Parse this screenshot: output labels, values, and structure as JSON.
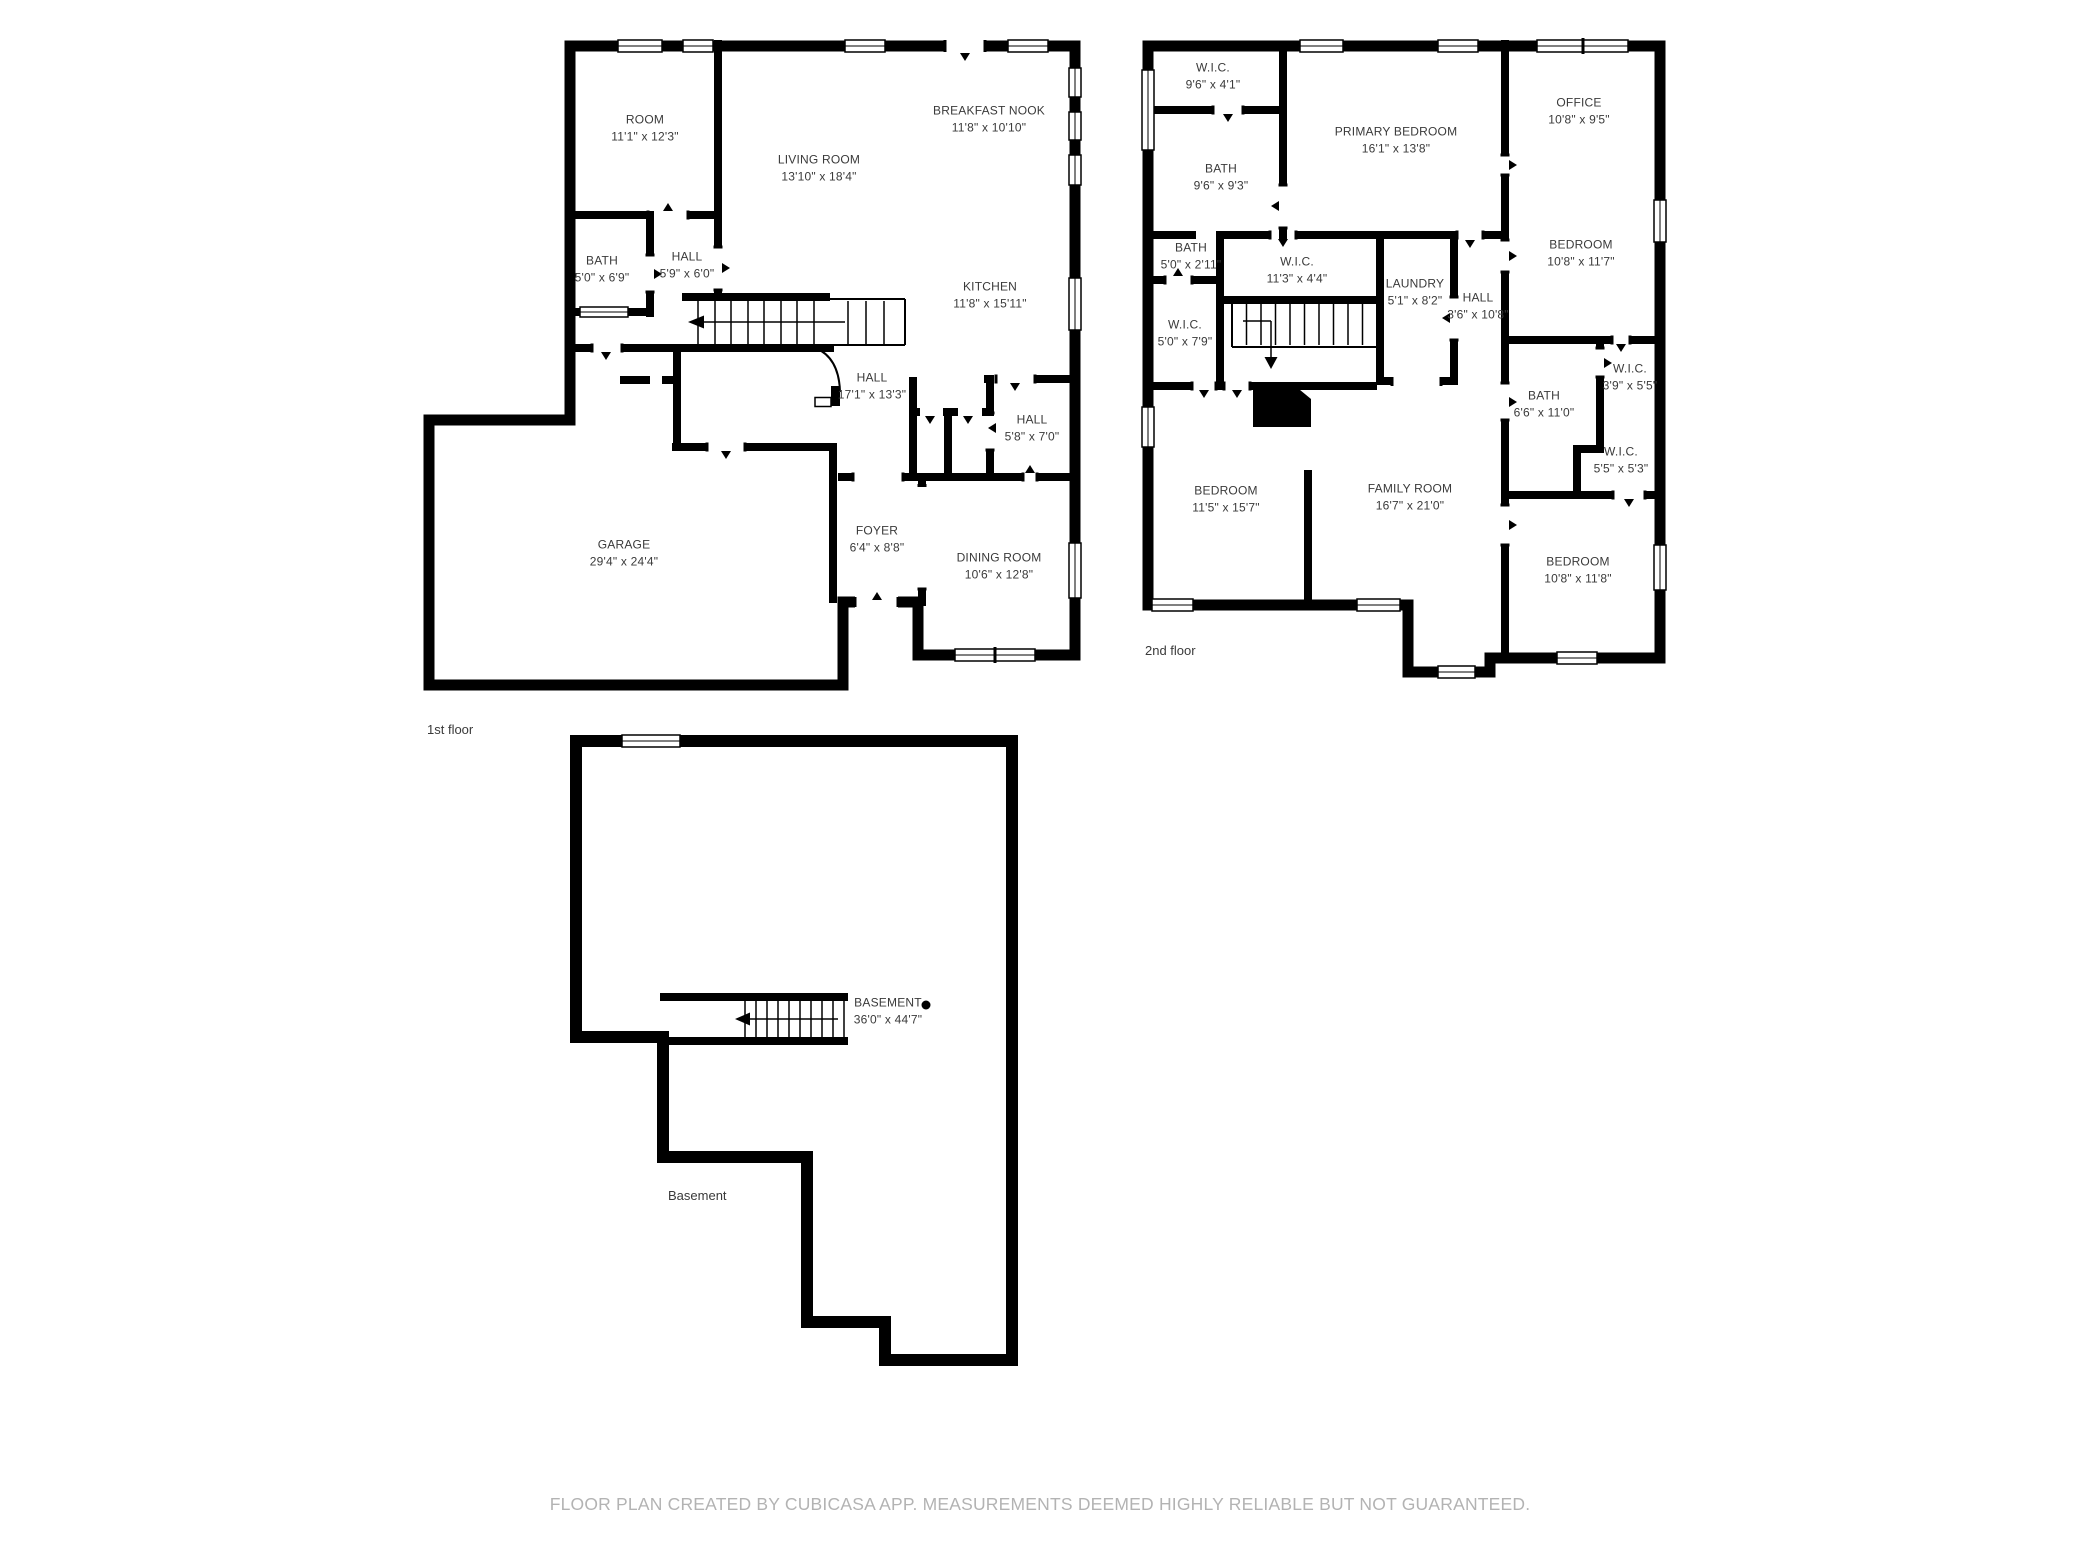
{
  "floors": [
    {
      "name": "1st floor",
      "name_pos": {
        "x": 427,
        "y": 722
      },
      "rooms": [
        {
          "label": "ROOM",
          "dims": "11'1\" x 12'3\"",
          "x": 645,
          "y": 128
        },
        {
          "label": "LIVING ROOM",
          "dims": "13'10\" x 18'4\"",
          "x": 819,
          "y": 168
        },
        {
          "label": "BREAKFAST NOOK",
          "dims": "11'8\" x 10'10\"",
          "x": 989,
          "y": 119
        },
        {
          "label": "KITCHEN",
          "dims": "11'8\" x 15'11\"",
          "x": 990,
          "y": 295
        },
        {
          "label": "BATH",
          "dims": "5'0\" x 6'9\"",
          "x": 602,
          "y": 269
        },
        {
          "label": "HALL",
          "dims": "5'9\" x 6'0\"",
          "x": 687,
          "y": 265
        },
        {
          "label": "HALL",
          "dims": "17'1\" x 13'3\"",
          "x": 872,
          "y": 386
        },
        {
          "label": "HALL",
          "dims": "5'8\" x 7'0\"",
          "x": 1032,
          "y": 428
        },
        {
          "label": "FOYER",
          "dims": "6'4\" x 8'8\"",
          "x": 877,
          "y": 539
        },
        {
          "label": "DINING ROOM",
          "dims": "10'6\" x 12'8\"",
          "x": 999,
          "y": 566
        },
        {
          "label": "GARAGE",
          "dims": "29'4\" x 24'4\"",
          "x": 624,
          "y": 553
        }
      ]
    },
    {
      "name": "2nd floor",
      "name_pos": {
        "x": 1145,
        "y": 643
      },
      "rooms": [
        {
          "label": "W.I.C.",
          "dims": "9'6\" x 4'1\"",
          "x": 1213,
          "y": 76
        },
        {
          "label": "PRIMARY BEDROOM",
          "dims": "16'1\" x 13'8\"",
          "x": 1396,
          "y": 140
        },
        {
          "label": "OFFICE",
          "dims": "10'8\" x 9'5\"",
          "x": 1579,
          "y": 111
        },
        {
          "label": "BATH",
          "dims": "9'6\" x 9'3\"",
          "x": 1221,
          "y": 177
        },
        {
          "label": "BEDROOM",
          "dims": "10'8\" x 11'7\"",
          "x": 1581,
          "y": 253
        },
        {
          "label": "BATH",
          "dims": "5'0\" x 2'11\"",
          "x": 1191,
          "y": 256
        },
        {
          "label": "W.I.C.",
          "dims": "11'3\" x 4'4\"",
          "x": 1297,
          "y": 270
        },
        {
          "label": "LAUNDRY",
          "dims": "5'1\" x 8'2\"",
          "x": 1415,
          "y": 292
        },
        {
          "label": "HALL",
          "dims": "3'6\" x 10'8\"",
          "x": 1478,
          "y": 306
        },
        {
          "label": "W.I.C.",
          "dims": "5'0\" x 7'9\"",
          "x": 1185,
          "y": 333
        },
        {
          "label": "BATH",
          "dims": "6'6\" x 11'0\"",
          "x": 1544,
          "y": 404
        },
        {
          "label": "W.I.C.",
          "dims": "3'9\" x 5'5\"",
          "x": 1630,
          "y": 377
        },
        {
          "label": "W.I.C.",
          "dims": "5'5\" x 5'3\"",
          "x": 1621,
          "y": 460
        },
        {
          "label": "BEDROOM",
          "dims": "11'5\" x 15'7\"",
          "x": 1226,
          "y": 499
        },
        {
          "label": "FAMILY ROOM",
          "dims": "16'7\" x 21'0\"",
          "x": 1410,
          "y": 497
        },
        {
          "label": "BEDROOM",
          "dims": "10'8\" x 11'8\"",
          "x": 1578,
          "y": 570
        }
      ]
    },
    {
      "name": "Basement",
      "name_pos": {
        "x": 668,
        "y": 1188
      },
      "rooms": [
        {
          "label": "BASEMENT",
          "dims": "36'0\" x 44'7\"",
          "x": 888,
          "y": 1011
        }
      ]
    }
  ],
  "footer": {
    "text": "FLOOR PLAN CREATED BY CUBICASA APP. MEASUREMENTS DEEMED HIGHLY RELIABLE BUT NOT GUARANTEED."
  },
  "colors": {
    "wall": "#000000",
    "label": "#3a3a3a",
    "footer": "#b3b3b3"
  }
}
